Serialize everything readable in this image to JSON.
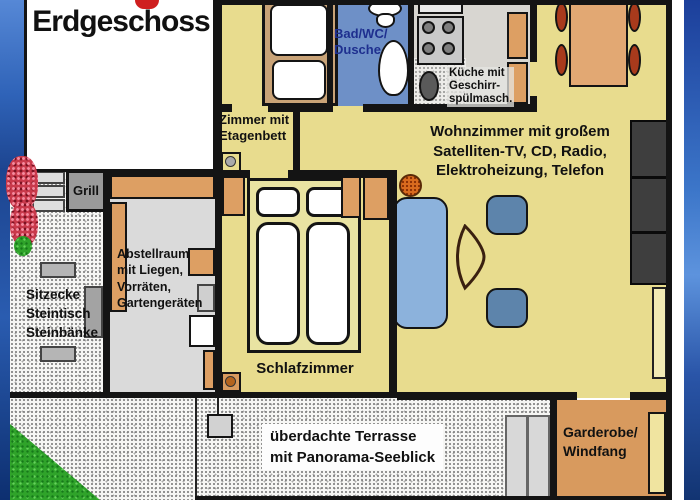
{
  "plan": {
    "title": "Erdgeschoss",
    "rooms": {
      "bunk_room": "Zimmer mit\nEtagenbett",
      "bathroom": "Bad/WC/\nDusche",
      "kitchen": "Küche mit\nGeschirr-\nspülmasch.",
      "living_room": "Wohnzimmer mit großem\nSatelliten-TV, CD, Radio,\nElektroheizung, Telefon",
      "bedroom": "Schlafzimmer",
      "storage": "Abstellraum\nmit Liegen,\nVorräten,\nGartengeräten",
      "seating_area": "Sitzecke\nSteintisch\nSteinbänke",
      "grill": "Grill",
      "terrace": "überdachte Terrasse\nmit Panorama-Seeblick",
      "entry": "Garderobe/\nWindfang"
    },
    "palette": {
      "floor_yellow": "#e8dc8e",
      "bath_blue": "#6e90c7",
      "furniture_tan": "#dd9f63",
      "dining_chair_red": "#a83a1c",
      "sofa_blue": "#8cb2dc",
      "armchair_blue": "#5d84ab",
      "cabinet_dark": "#3e3e3e",
      "entry_floor_orange": "#d89a5e",
      "grass_green": "#2fa32a",
      "background_blue": "#2a52b0",
      "bath_label_navy": "#1e2f8f",
      "title_red_fragment": "#cf1f1f"
    }
  }
}
